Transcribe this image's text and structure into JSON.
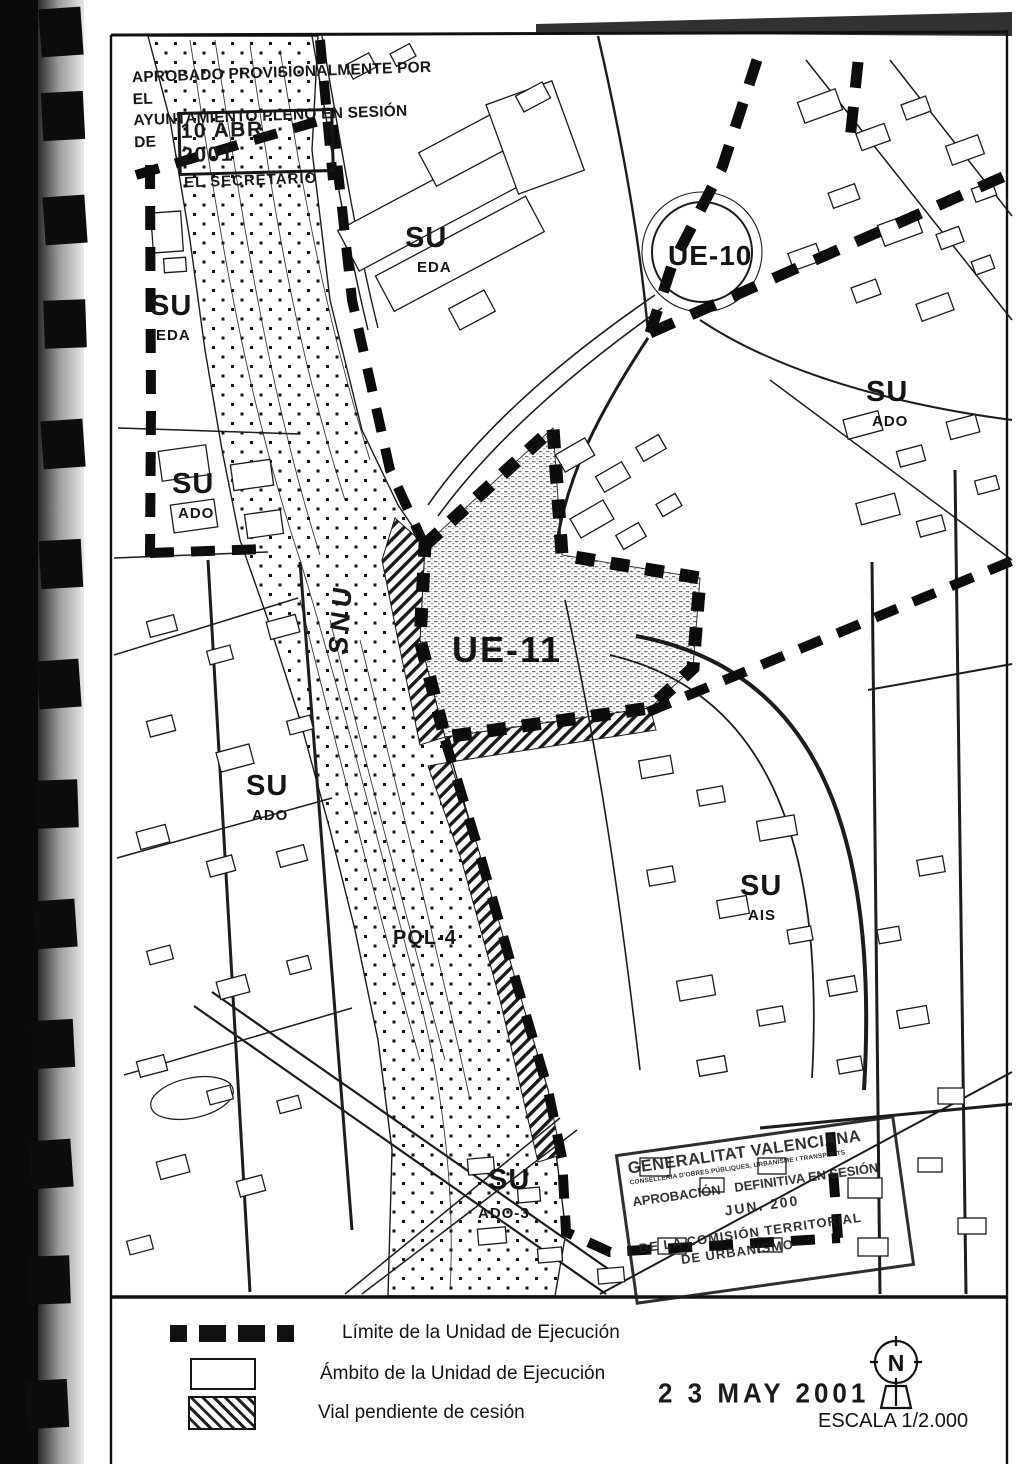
{
  "approval_stamp": {
    "line1": "APROBADO PROVISIONALMENTE POR EL",
    "line2": "AYUNTAMIENTO PLENO EN SESIÓN DE",
    "date": "10 ABR. 2001",
    "signer": "EL SECRETARIO"
  },
  "zones": {
    "su_eda_top": {
      "main": "SU",
      "sub": "EDA"
    },
    "su_eda_left": {
      "main": "SU",
      "sub": "EDA"
    },
    "ue10": {
      "label": "UE-10"
    },
    "su_ado_right": {
      "main": "SU",
      "sub": "ADO"
    },
    "su_ado_left": {
      "main": "SU",
      "sub": "ADO"
    },
    "snu": {
      "label": "SNU"
    },
    "ue11": {
      "label": "UE-11"
    },
    "su_ado_mid": {
      "main": "SU",
      "sub": "ADO"
    },
    "pql4": {
      "label": "PQL-4"
    },
    "su_ais": {
      "main": "SU",
      "sub": "AIS"
    },
    "su_ado3": {
      "main": "SU",
      "sub": "ADO-3"
    }
  },
  "authority_stamp": {
    "title": "GENERALITAT VALENCIANA",
    "subtitle": "CONSELLERIA D'OBRES PÚBLIQUES, URBANISME I TRANSPORTS",
    "line1": "APROBACIÓN",
    "line2": "DEFINITIVA EN SESIÓN",
    "date": "JUN. 200",
    "line3": "DE LA COMISIÓN TERRITORIAL",
    "line4": "DE URBANISMO"
  },
  "legend": {
    "items": [
      {
        "label": "Límite de la Unidad de Ejecución"
      },
      {
        "label": "Ámbito de la Unidad de Ejecución"
      },
      {
        "label": "Vial pendiente de cesión"
      }
    ]
  },
  "date_stamp": "2 3 MAY 2001",
  "scale": "ESCALA 1/2.000",
  "north": "N",
  "colors": {
    "ink": "#111111",
    "paper": "#ffffff"
  }
}
